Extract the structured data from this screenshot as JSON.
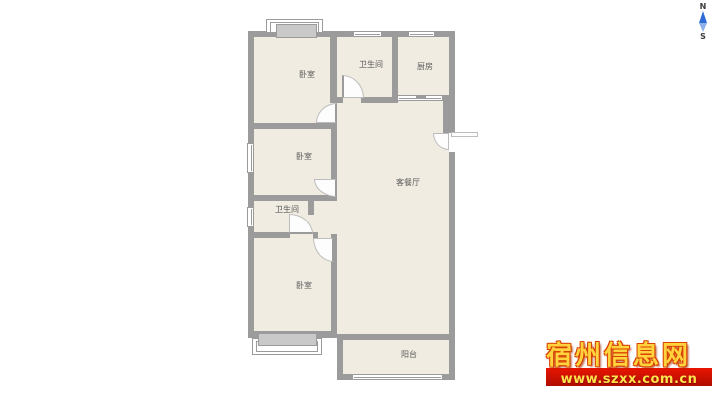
{
  "compass": {
    "north_label": "N",
    "south_label": "S"
  },
  "floorplan": {
    "rooms": [
      {
        "id": "bedroom-top",
        "label": "卧室"
      },
      {
        "id": "bathroom-top",
        "label": "卫生间"
      },
      {
        "id": "kitchen",
        "label": "厨房"
      },
      {
        "id": "bedroom-middle",
        "label": "卧室"
      },
      {
        "id": "bathroom-middle",
        "label": "卫生间"
      },
      {
        "id": "living-dining",
        "label": "客餐厅"
      },
      {
        "id": "bedroom-bottom",
        "label": "卧室"
      },
      {
        "id": "balcony",
        "label": "阳台"
      }
    ],
    "colors": {
      "wall": "#9b9b9b",
      "room_fill": "#f0ece1",
      "background": "#ffffff",
      "label_text": "#5a5a5a",
      "compass_needle": "#2f6bd7",
      "compass_needle_light": "#8fb0e8"
    }
  },
  "watermark": {
    "site_name": "宿州信息网",
    "url": "www.szxx.com.cn",
    "colors": {
      "text": "#ffd23e",
      "outline": "#d84300",
      "banner": "#b00d00",
      "banner_text": "#ffe34d"
    }
  }
}
